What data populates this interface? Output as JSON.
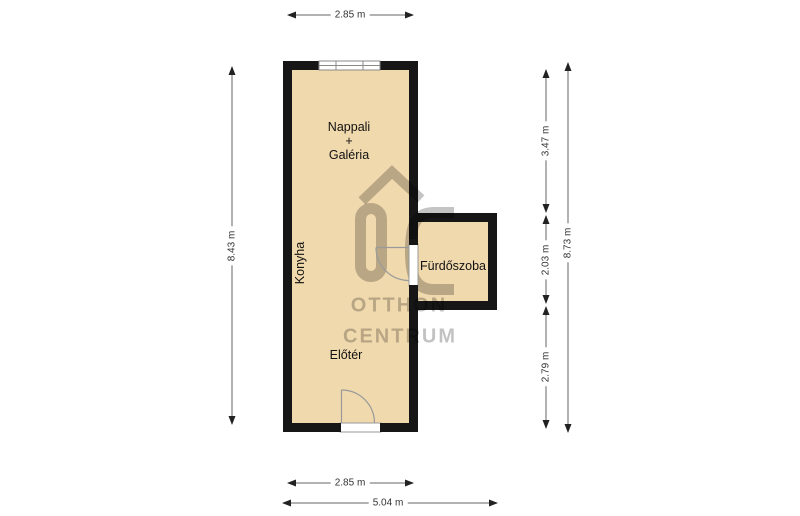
{
  "title": "Floor plan",
  "rooms": {
    "nappali": {
      "line1": "Nappali",
      "line2": "+",
      "line3": "Galéria"
    },
    "konyha": {
      "label": "Konyha"
    },
    "furdoszoba": {
      "label": "Fürdőszoba"
    },
    "eloter": {
      "label": "Előtér"
    }
  },
  "dimensions": {
    "top_width": "2.85 m",
    "left_height": "8.43 m",
    "right_upper": "3.47 m",
    "right_middle": "2.03 m",
    "right_lower": "2.79 m",
    "right_total": "8.73 m",
    "bottom_width": "2.85 m",
    "bottom_total": "5.04 m"
  },
  "watermark": {
    "logo": "otthon-centrum-house-logo",
    "line1": "OTTHON",
    "line2": "CENTRUM"
  },
  "colors": {
    "floor": "#f1d9ae",
    "wall": "#161616",
    "watermark": "rgba(0,0,0,0.23)",
    "dimension_line": "#666666",
    "dimension_text": "#333333"
  }
}
